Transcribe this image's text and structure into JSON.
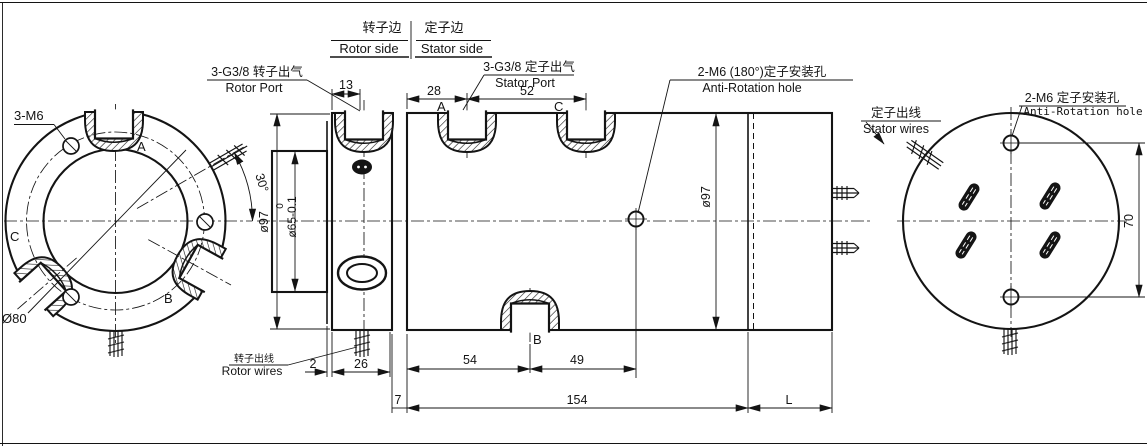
{
  "title": "Pneumatic rotary union engineering drawing",
  "colors": {
    "ink": "#141414",
    "paper": "#ffffff"
  },
  "header": {
    "rotor_cn": "转子边",
    "rotor_en": "Rotor side",
    "stator_cn": "定子边",
    "stator_en": "Stator side"
  },
  "callouts": {
    "rotor_port": {
      "cn": "3-G3/8 转子出气",
      "en": "Rotor Port"
    },
    "stator_port": {
      "cn": "3-G3/8 定子出气",
      "en": "Stator Port"
    },
    "anti_rotation_180": {
      "cn": "2-M6 (180°)定子安装孔",
      "en": "Anti-Rotation hole"
    },
    "stator_wires": {
      "cn": "定子出线",
      "en": "Stator wires"
    },
    "anti_rotation_2m6": {
      "cn": "2-M6 定子安装孔",
      "en": "Anti-Rotation hole"
    },
    "rotor_wires": {
      "cn": "转子出线",
      "en": "Rotor wires"
    },
    "mounting_holes": "3-M6"
  },
  "ports": {
    "front": {
      "a": "A",
      "b": "B",
      "c": "C"
    },
    "section": {
      "a": "A",
      "b": "B",
      "c": "C"
    }
  },
  "dims": {
    "flange_thickness": "13",
    "port_a": "28",
    "port_ac": "52",
    "rotor_flange_od": "ø97",
    "tol_upper": "0",
    "shaft_od": "ø65-0.1",
    "stator_od": "ø97",
    "wire_angle": "30°",
    "bolt_circle": "Ø80",
    "gap": "2",
    "hub_length": "26",
    "port_b_pos": "54",
    "hole_offset": "49",
    "gap2": "7",
    "body_length": "154",
    "custom_length": "L",
    "hole_span": "70"
  }
}
